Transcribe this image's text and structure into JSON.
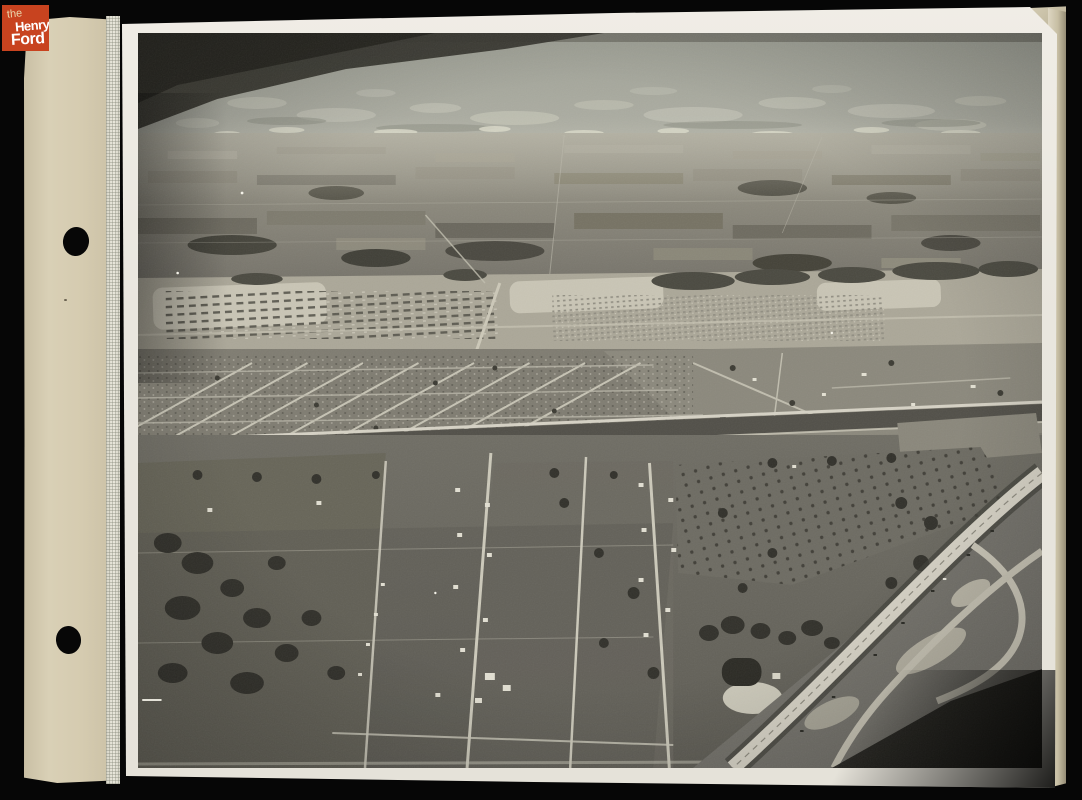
{
  "branding": {
    "logo_lines": [
      "the",
      "Henry",
      "Ford"
    ],
    "logo_background": "#c8431f",
    "logo_text_color": "#ffffff",
    "logo_the_color": "#ead8ae"
  },
  "photo": {
    "alt": "Black-and-white aerial photograph of a partially developed suburban and rural landscape: cloudy sky over distant patchwork farmland, a band of wartime housing rows and trailer lots, a gridded residential subdivision, a straight east-west road, foreground fields with orchards, scattered farmhouses and tree clusters, and a new divided highway with curved interchange ramps crossing the lower right corner"
  },
  "album": {
    "paper_color": "#d5cbb0",
    "photo_border_color": "#ebe8e0",
    "background_color": "#060606",
    "punch_hole_count": "2"
  }
}
